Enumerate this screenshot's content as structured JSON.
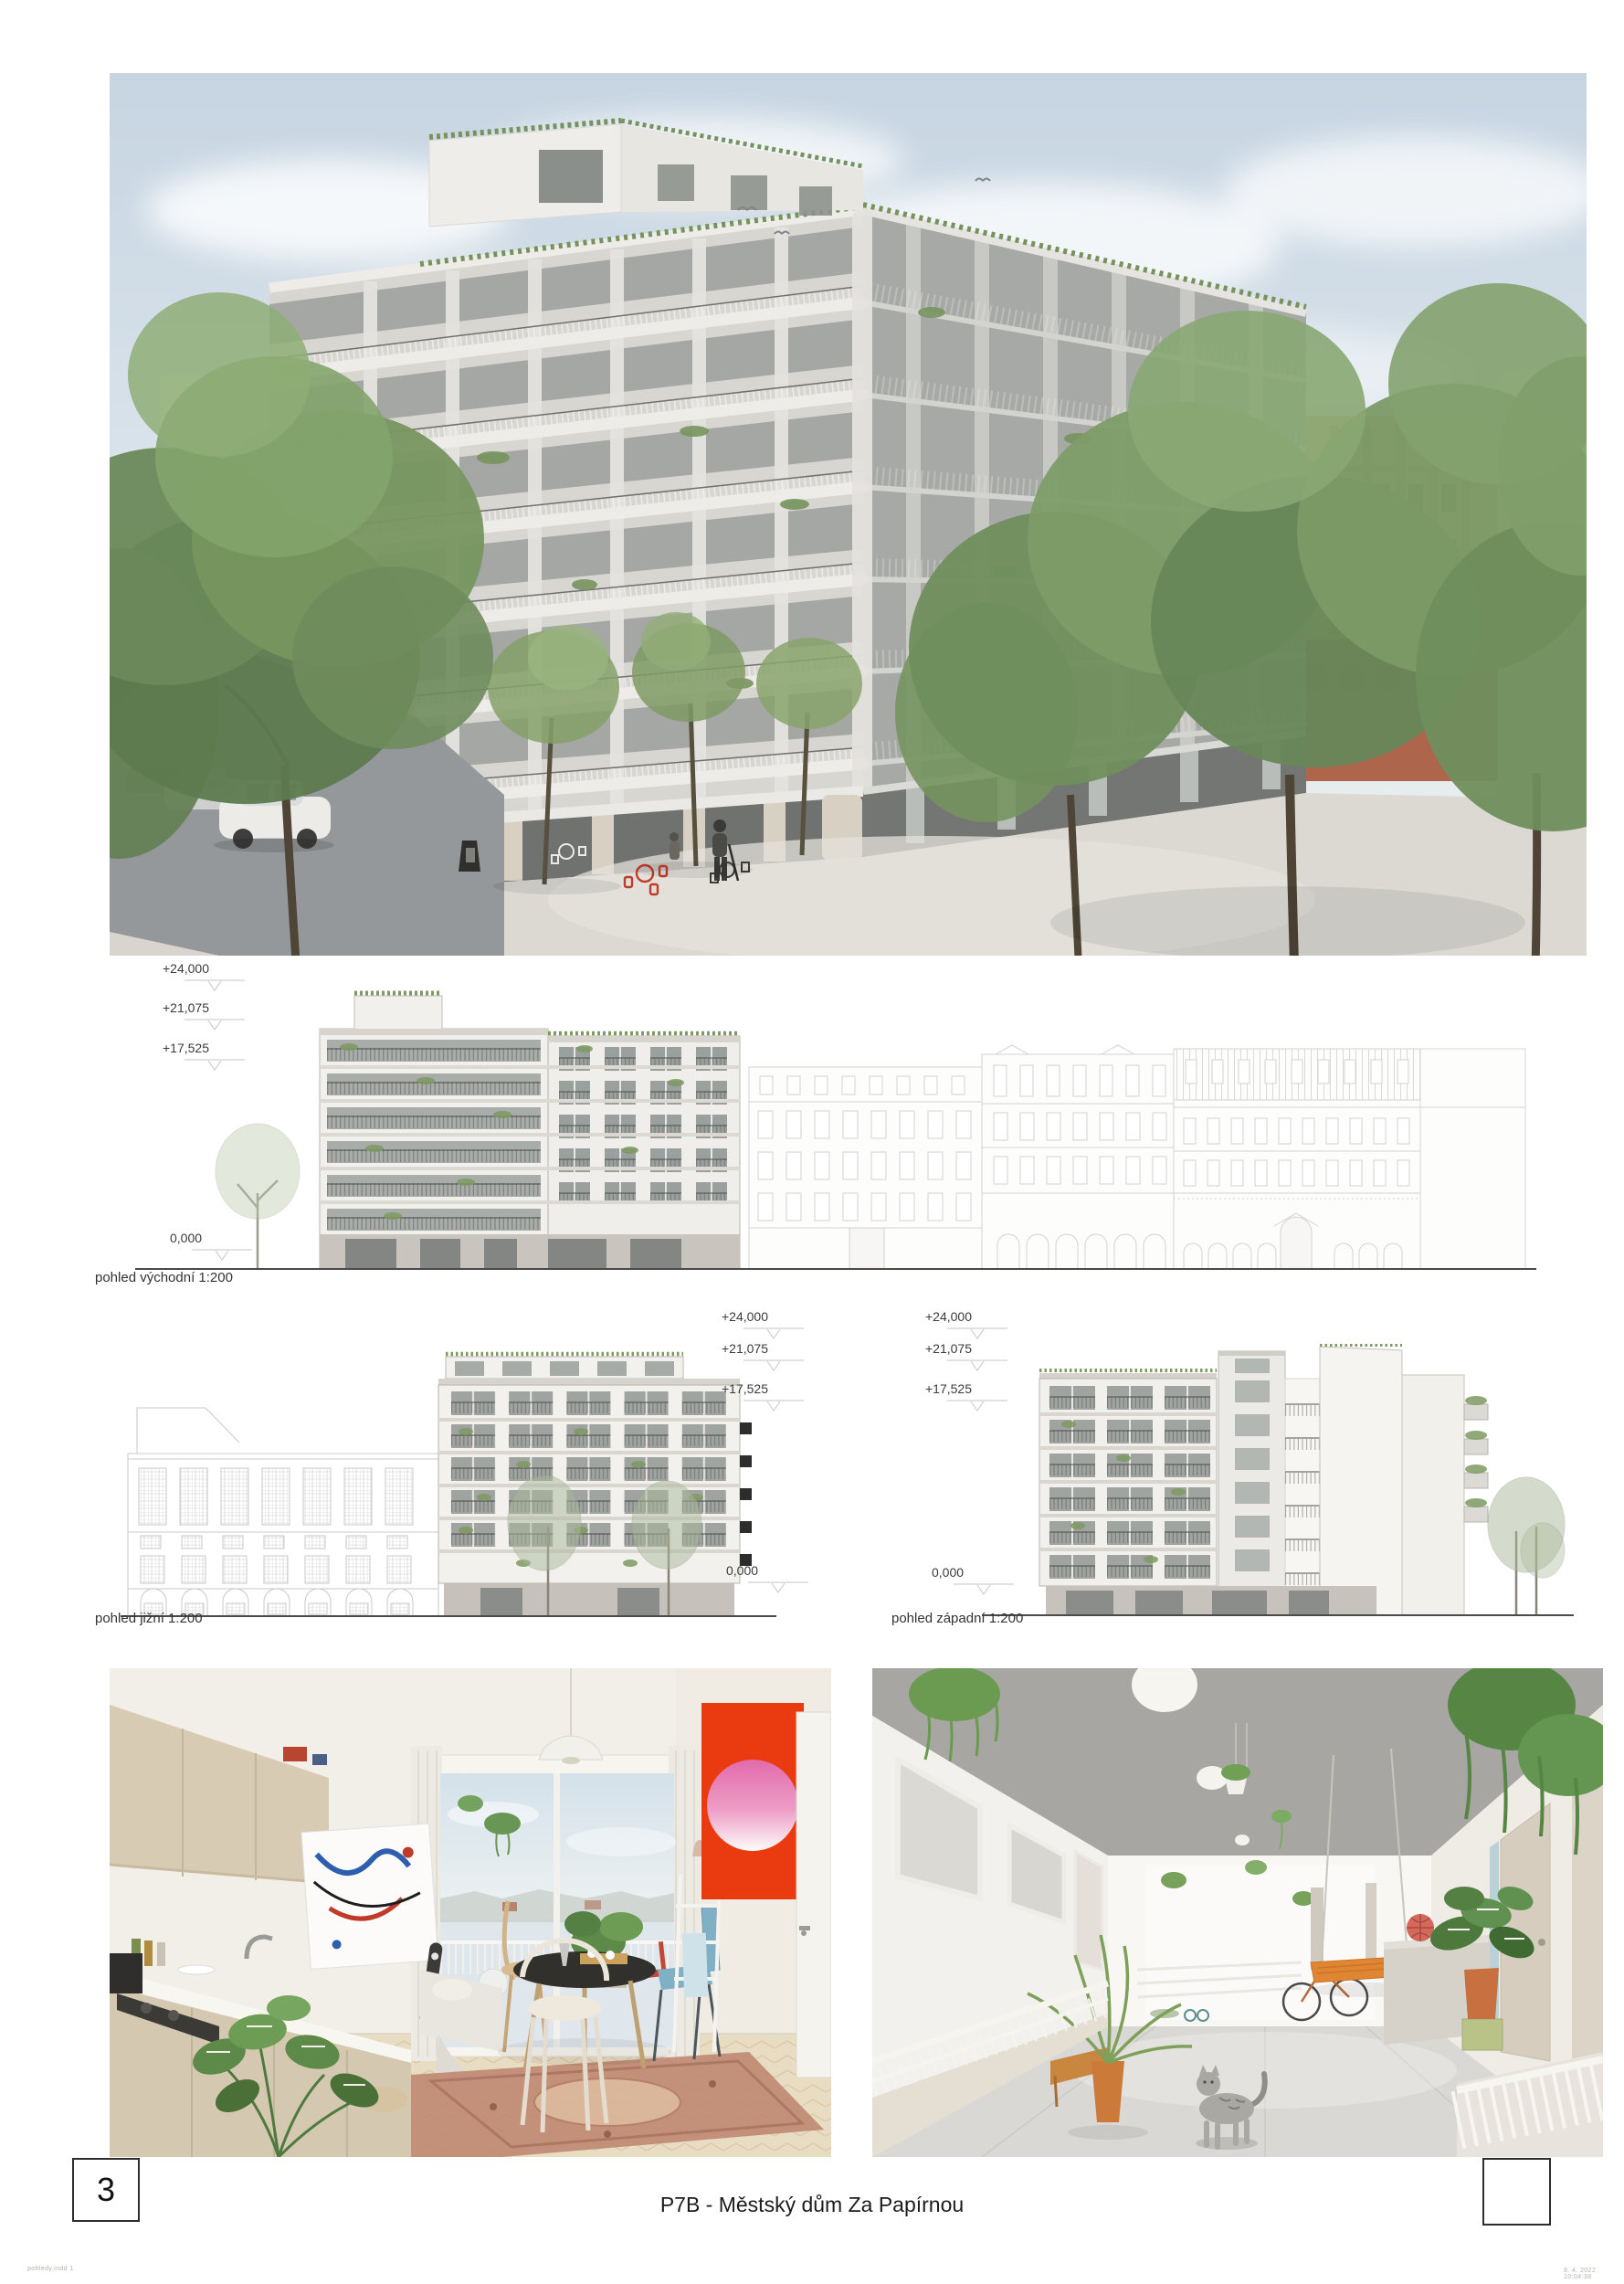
{
  "page": {
    "number": "3",
    "title": "P7B - Městský dům Za Papírnou",
    "print_footer_left": "pohledy.indd   1",
    "print_footer_right": "8. 4. 2022   10:04:38"
  },
  "elevations": {
    "east": {
      "caption": "pohled východní 1:200",
      "levels": {
        "l24": "+24,000",
        "l21": "+21,075",
        "l17": "+17,525"
      },
      "zero": "0,000"
    },
    "south": {
      "caption": "pohled jižní 1:200",
      "levels": {
        "l24": "+24,000",
        "l21": "+21,075",
        "l17": "+17,525"
      },
      "zero": "0,000"
    },
    "west": {
      "caption": "pohled západní 1:200",
      "levels": {
        "l24": "+24,000",
        "l21": "+21,075",
        "l17": "+17,525"
      },
      "zero": "0,000"
    }
  },
  "figures": {
    "main_render_alt": "street corner rendering of the new apartment building",
    "interior_left_alt": "interior rendering - kitchen and dining room",
    "interior_right_alt": "access gallery rendering with plants and a cat"
  },
  "colors": {
    "vegetation_green": "#7e9a62",
    "poster_red": "#ea3a10",
    "swing_orange": "#e08632",
    "facade_white": "#f3f1ed",
    "glass_gray": "#9fa3a1",
    "drawing_line_gray": "#d2d2d2",
    "sky_blue": "#ccd9e4",
    "ink": "#2e2e2e"
  }
}
